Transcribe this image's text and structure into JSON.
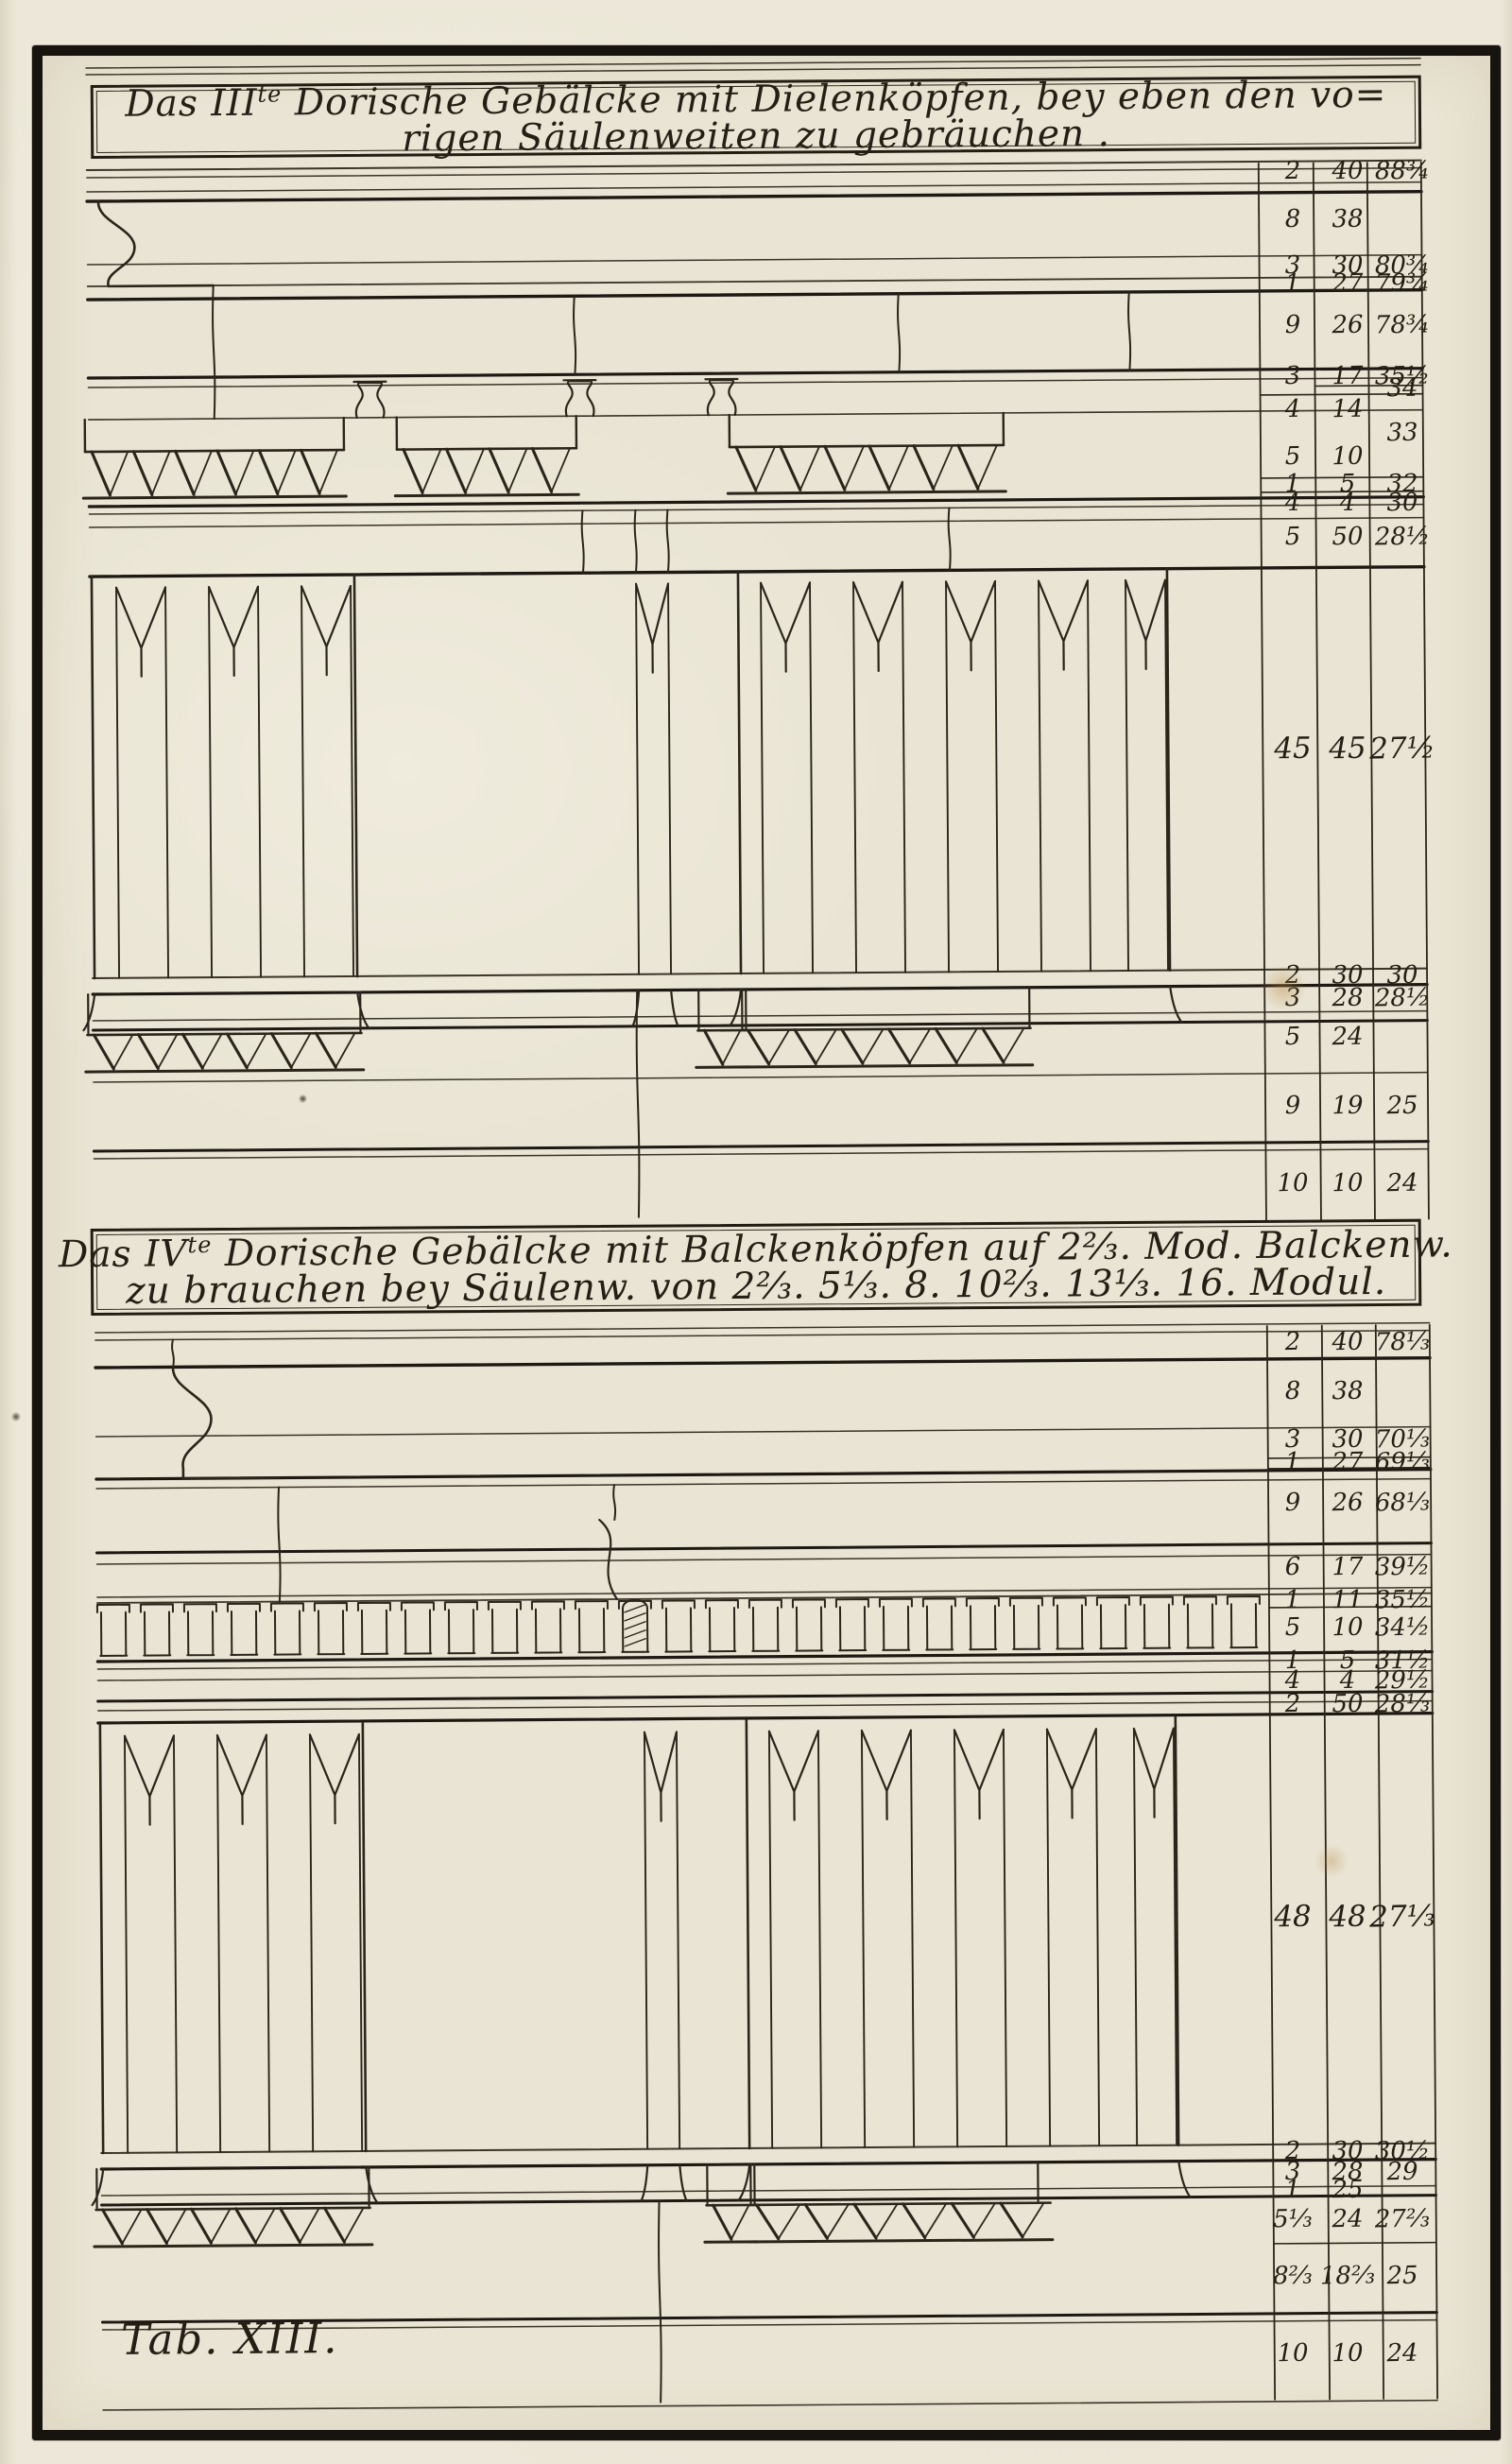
{
  "plate": {
    "tab_label": "Tab. XIII.",
    "medium": "engraved architectural plate"
  },
  "sections": [
    {
      "number": "III",
      "title": {
        "pre": "Das III",
        "sup": "te",
        "line1_rest": " Dorische Gebälcke mit Dielenköpfen, bey eben den vo=",
        "line2": "rigen Säulenweiten zu gebräuchen ."
      },
      "table": {
        "rows": [
          [
            "2",
            "40",
            "88¾"
          ],
          [
            "8",
            "38",
            ""
          ],
          [
            "3",
            "30",
            "80¾"
          ],
          [
            "1",
            "27",
            "79¾"
          ],
          [
            "9",
            "26",
            "78¾"
          ],
          [
            "3",
            "17",
            "35½"
          ],
          [
            "",
            "",
            "34"
          ],
          [
            "4",
            "14",
            ""
          ],
          [
            "",
            "",
            "33"
          ],
          [
            "5",
            "10",
            ""
          ],
          [
            "1",
            "5",
            "32"
          ],
          [
            "4",
            "4",
            "30"
          ],
          [
            "5",
            "50",
            "28½"
          ],
          [
            "45",
            "45",
            "27½"
          ],
          [
            "2",
            "30",
            "30"
          ],
          [
            "3",
            "28",
            "28½"
          ],
          [
            "5",
            "24",
            ""
          ],
          [
            "9",
            "19",
            "25"
          ],
          [
            "10",
            "10",
            "24"
          ]
        ]
      }
    },
    {
      "number": "IV",
      "title": {
        "pre": "Das IV",
        "sup": "te",
        "line1_rest": " Dorische Gebälcke mit Balckenköpfen auf 2⅔. Mod. Balckenw.",
        "line2": "zu brauchen bey Säulenw. von 2⅔. 5⅓. 8. 10⅔. 13⅓. 16. Modul."
      },
      "table": {
        "rows": [
          [
            "2",
            "40",
            "78⅓"
          ],
          [
            "8",
            "38",
            ""
          ],
          [
            "3",
            "30",
            "70⅓"
          ],
          [
            "1",
            "27",
            "69⅓"
          ],
          [
            "9",
            "26",
            "68⅓"
          ],
          [
            "6",
            "17",
            "39½"
          ],
          [
            "1",
            "11",
            "35½"
          ],
          [
            "5",
            "10",
            "34½"
          ],
          [
            "1",
            "5",
            "31½"
          ],
          [
            "4",
            "4",
            "29½"
          ],
          [
            "2",
            "50",
            "28⅓"
          ],
          [
            "48",
            "48",
            "27⅓"
          ],
          [
            "2",
            "30",
            "30½"
          ],
          [
            "3",
            "28",
            "29"
          ],
          [
            "1",
            "25",
            ""
          ],
          [
            "5⅓",
            "24",
            "27⅔"
          ],
          [
            "8⅔",
            "18⅔",
            "25"
          ],
          [
            "10",
            "10",
            "24"
          ]
        ]
      }
    }
  ],
  "colors": {
    "paper": "#e9e4d3",
    "ink": "#241e14",
    "frame": "#17130e"
  }
}
